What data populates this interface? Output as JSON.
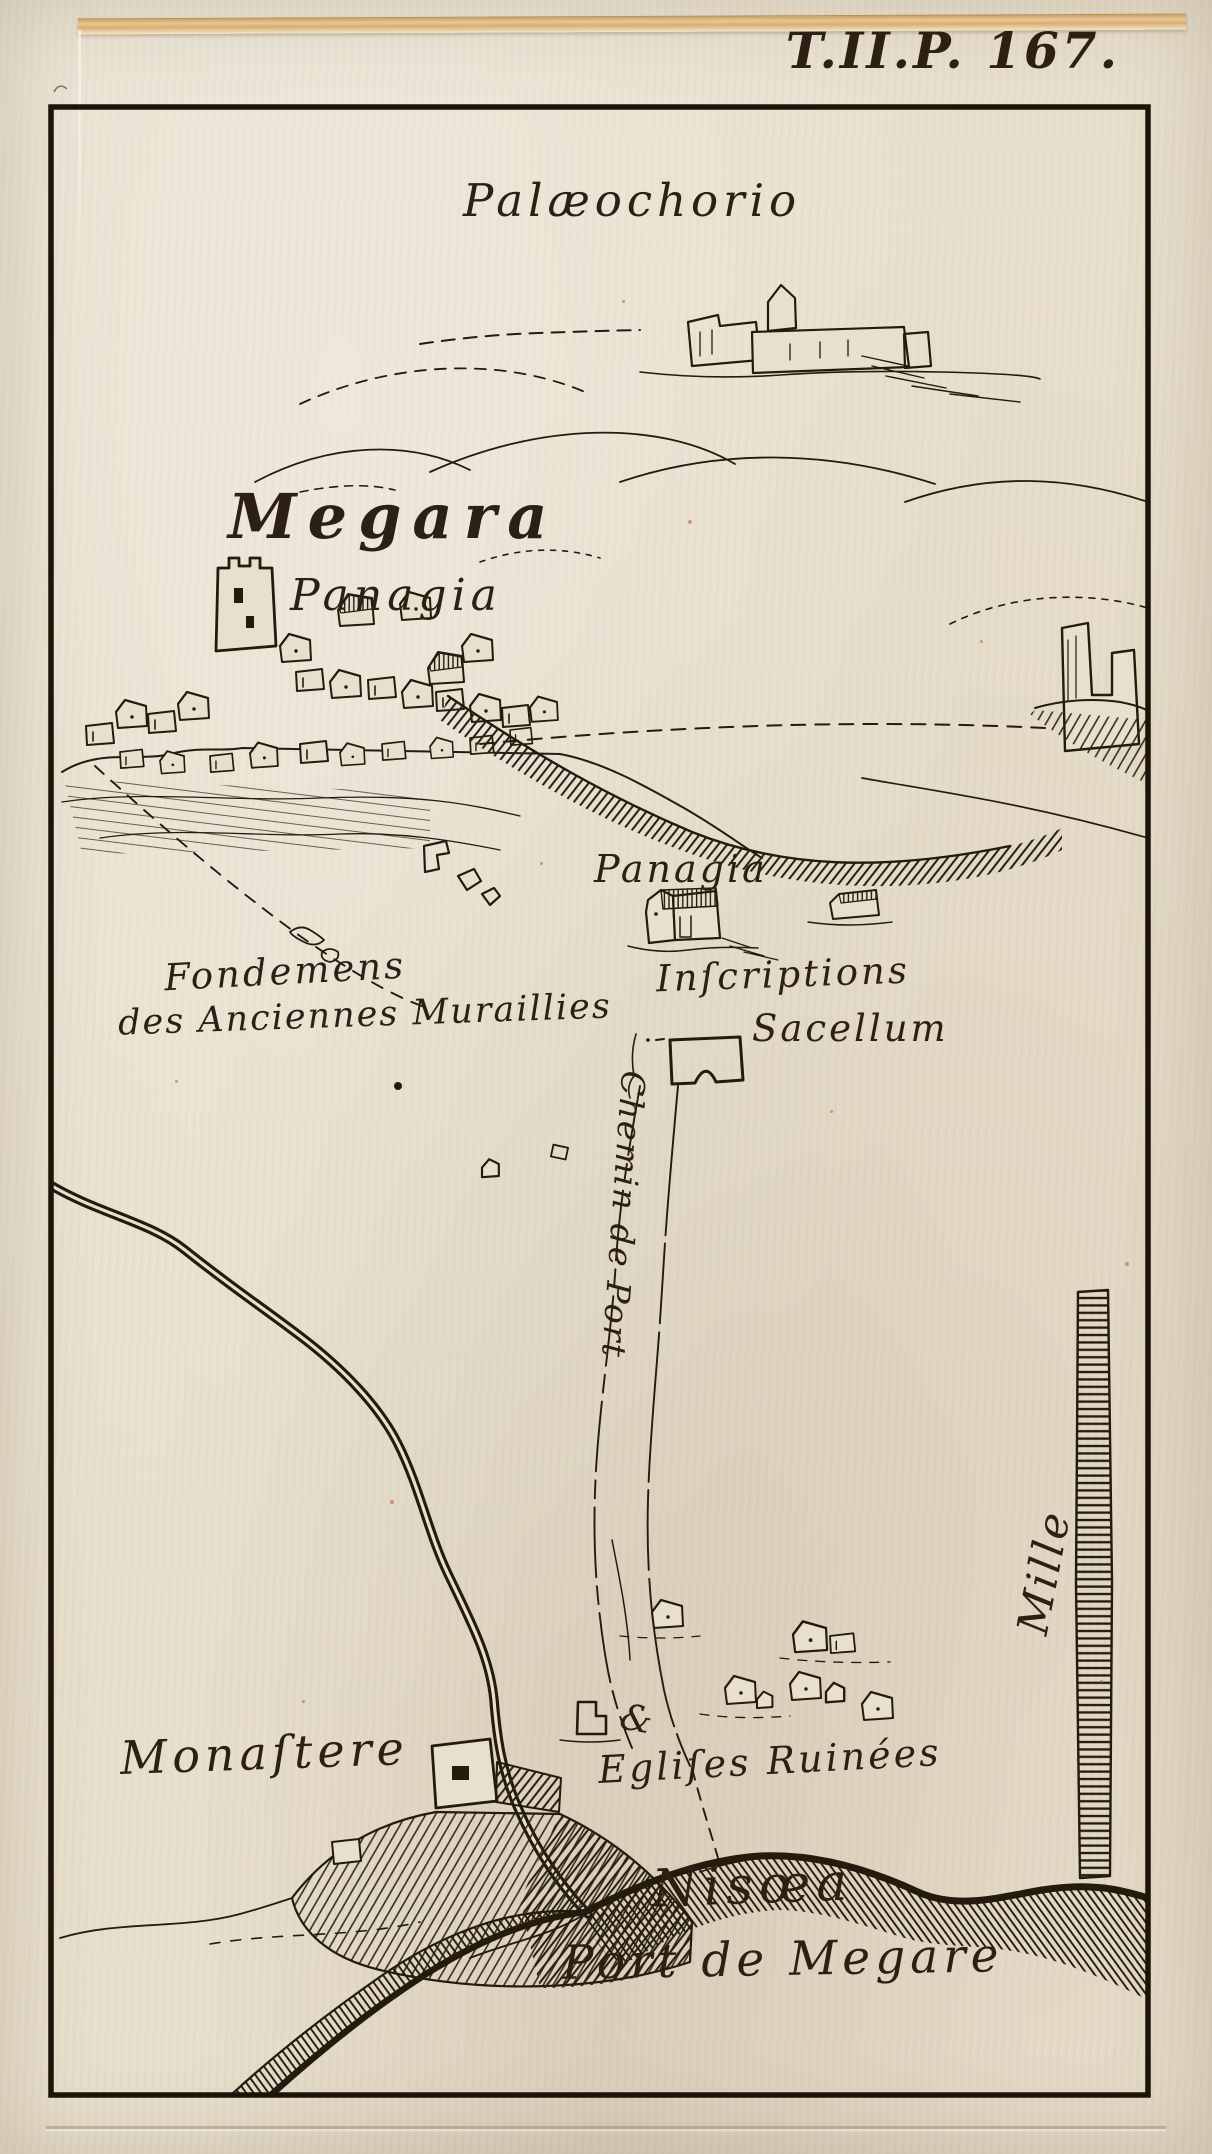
{
  "plate_ref": "T.II.P. 167.",
  "map": {
    "title_place": "Megara",
    "labels": {
      "palaeochorio": "Palæochorio",
      "megara": "Megara",
      "panagia_town": "Panagia",
      "panagia_chapel": "Panagia",
      "fondemens_line1": "Fondemens",
      "fondemens_line2": "des Anciennes Muraillies",
      "inscriptions": "Inſcriptions",
      "sacellum": "Sacellum",
      "chemin_de_port": "Chemin de Port",
      "mille": "Mille",
      "monastere": "Monaſtere",
      "eglises_ruinees": "Egliſes Ruinées",
      "ampersand_mark": "&",
      "nisaea": "Nisœa",
      "port_de_megare": "Port de Megare"
    },
    "colors": {
      "ink": "#261b0e",
      "paper": "#e8dfcd",
      "outer_paper": "#cbc3b4",
      "fold_tan": "#d9ad72",
      "fleck_red": "#be5828"
    }
  }
}
